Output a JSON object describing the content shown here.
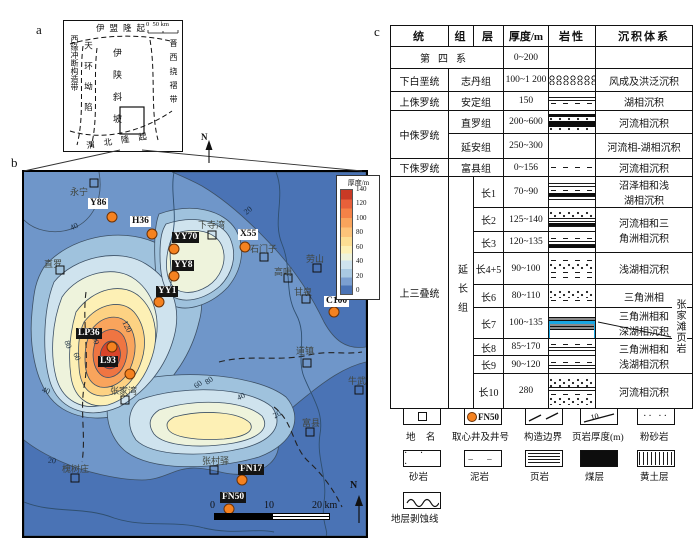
{
  "panels": {
    "a": "a",
    "b": "b",
    "c": "c"
  },
  "panel_a": {
    "scale_start": "0",
    "scale_end": "50 km",
    "north": "N",
    "tectonic_units": {
      "yimeng": "伊盟隆起",
      "xiyuan": "西缘冲断构造带",
      "tianhuan": "天环坳陷",
      "yishan": "伊陕斜坡",
      "jinxi": "晋西挠褶带",
      "weibei": "渭北隆起"
    }
  },
  "panel_b": {
    "colorbar": {
      "title": "厚度/m",
      "ticks": [
        "140",
        "120",
        "100",
        "80",
        "60",
        "40",
        "20",
        "0"
      ],
      "colors": [
        "#c93a25",
        "#e8603a",
        "#f58247",
        "#f9a45c",
        "#fdc379",
        "#fdde93",
        "#fdf0b5",
        "#eef3dc",
        "#cfe3ee",
        "#a9c9e2",
        "#7b9fd0",
        "#4a73b5"
      ]
    },
    "wells": [
      "Y86",
      "H36",
      "YY70",
      "YY8",
      "YY1",
      "X55",
      "C100",
      "LP36",
      "L93",
      "FN17",
      "FN50"
    ],
    "places": [
      "永宁",
      "下寺湾",
      "石门子",
      "劳山",
      "高哨",
      "甘泉",
      "道镇",
      "牛武",
      "直罗",
      "张家湾",
      "槐树庄",
      "张村驿",
      "富县"
    ],
    "contour_labels": [
      "40",
      "20",
      "120",
      "100",
      "80",
      "60",
      "40",
      "20",
      "60",
      "80",
      "40",
      "20"
    ],
    "scalebar": {
      "t0": "0",
      "t1": "10",
      "t2": "20 km"
    },
    "north": "N",
    "well_marker_color": "#f58220"
  },
  "panel_c": {
    "header": [
      "统",
      "组",
      "层",
      "厚度/m",
      "岩性",
      "沉积体系"
    ],
    "quaternary": {
      "name": "第四系",
      "thickness": "0~200",
      "system": ""
    },
    "rows": [
      {
        "series": "下白垩统",
        "formation": "志丹组",
        "thickness": "100~1 200",
        "system": "风成及洪泛沉积",
        "lithology": "sandstone with erosion surfaces"
      },
      {
        "series": "上侏罗统",
        "formation": "安定组",
        "thickness": "150",
        "system": "湖相沉积",
        "lithology": "sandstone-mudstone"
      },
      {
        "series": "中侏罗统",
        "formation": "直罗组",
        "thickness": "200~600",
        "system": "河流相沉积",
        "lithology": "sandstone with coal seams"
      },
      {
        "formation": "延安组",
        "thickness": "250~300",
        "system": "河流相-湖相沉积",
        "lithology": "sandstone"
      },
      {
        "series": "下侏罗统",
        "formation": "富县组",
        "thickness": "0~156",
        "system": "河流相沉积",
        "lithology": "sandstone-mudstone"
      }
    ],
    "triassic": {
      "series": "上三叠统",
      "formation": "延长组",
      "members": [
        {
          "name": "长1",
          "thickness": "70~90",
          "system": "沼泽相和浅\n湖相沉积"
        },
        {
          "name": "长2",
          "thickness": "125~140",
          "system": "河流相和三\n角洲相沉积"
        },
        {
          "name": "长3",
          "thickness": "120~135"
        },
        {
          "name": "长4+5",
          "thickness": "90~100",
          "system": "浅湖相沉积"
        },
        {
          "name": "长6",
          "thickness": "80~110",
          "system": "三角洲相"
        },
        {
          "name": "长7",
          "thickness": "100~135",
          "system": "三角洲相和\n深湖相沉积"
        },
        {
          "name": "长8",
          "thickness": "85~170",
          "system": "三角洲相和\n浅湖相沉积"
        },
        {
          "name": "长9",
          "thickness": "90~120"
        },
        {
          "name": "长10",
          "thickness": "280",
          "system": "河流相沉积"
        }
      ]
    },
    "annotation": "张家滩页岩",
    "highlight_color": "#19a6e2",
    "legend": {
      "row1": [
        {
          "label": "地 名"
        },
        {
          "label": "取心井及井号",
          "well": "FN50"
        },
        {
          "label": "构造边界"
        },
        {
          "label": "页岩厚度(m)",
          "value": "10"
        },
        {
          "label": "粉砂岩"
        }
      ],
      "row2": [
        {
          "label": "砂岩"
        },
        {
          "label": "泥岩"
        },
        {
          "label": "页岩"
        },
        {
          "label": "煤层"
        },
        {
          "label": "黄土层"
        }
      ],
      "row3": [
        {
          "label": "地层剥蚀线"
        }
      ]
    }
  }
}
